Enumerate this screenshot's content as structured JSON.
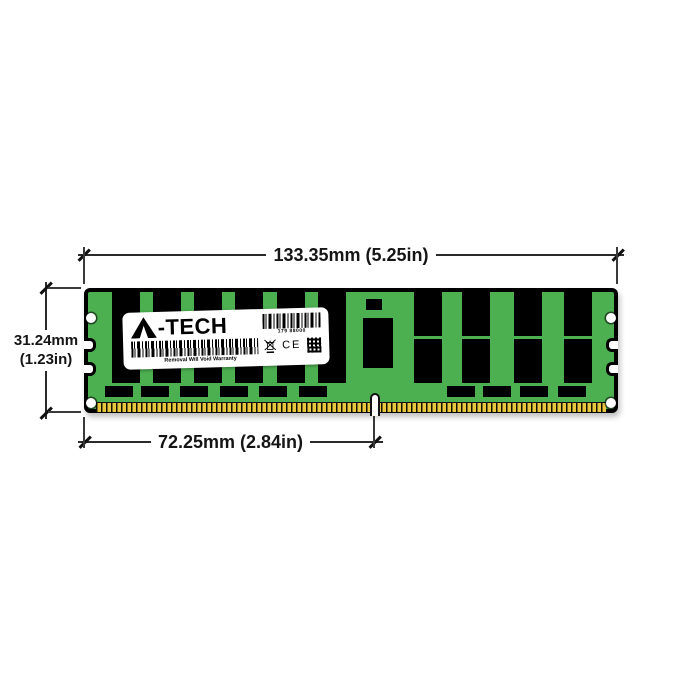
{
  "diagram": {
    "type": "product-dimension-diagram",
    "subject": "registered DIMM memory module, front view",
    "dimensions": {
      "width": "133.35mm (5.25in)",
      "height_line1": "31.24mm",
      "height_line2": "(1.23in)",
      "pin_span": "72.25mm (2.84in)"
    },
    "module": {
      "pcb_color": "#4caf50",
      "chip_color": "#000000",
      "pin_color": "#e8c63e",
      "left_chip_count": 6,
      "right_chip_columns": 4,
      "bottom_chip_count_left": 6,
      "bottom_chip_count_right": 4,
      "mounting_holes": 4,
      "edge_notches_per_side": 2
    },
    "label": {
      "brand": "A-TECH",
      "brand_suffix": "-TECH",
      "serial": "179 88000",
      "warranty_text": "Removal Will Void Warranty",
      "ce_mark": "CE"
    }
  }
}
